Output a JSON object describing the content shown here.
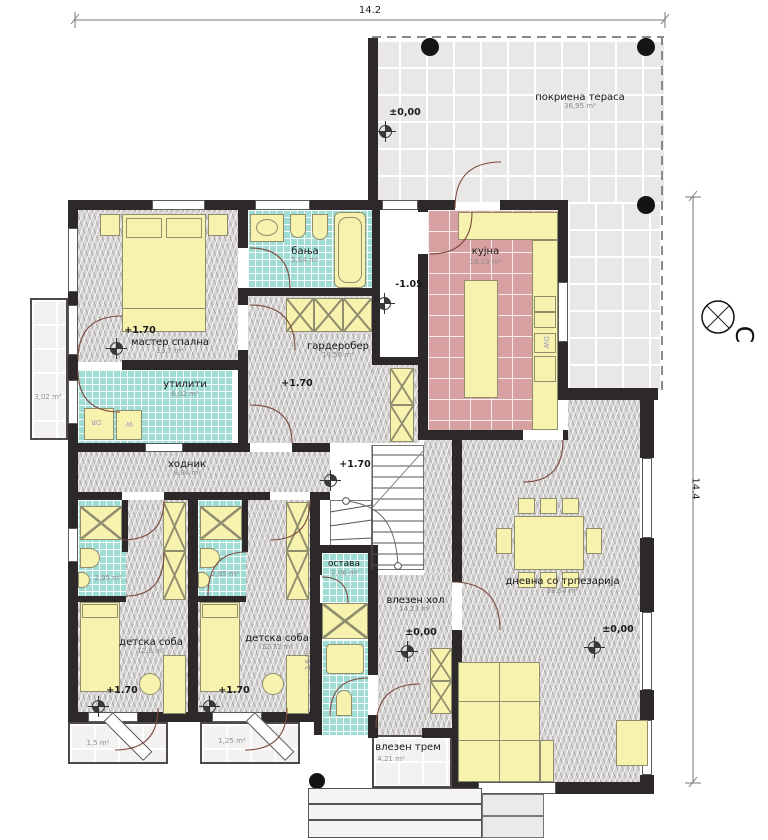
{
  "plan": {
    "dim_width": "14.2",
    "dim_height": "14.4",
    "north": "С"
  },
  "rooms": {
    "terrace": {
      "name": "покриена тераса",
      "area": "36,95 m²",
      "level": "±0,00"
    },
    "master": {
      "name": "мастер спална",
      "area": "13,7 m²",
      "level": "+1.70"
    },
    "master_balcony": {
      "area": "3,02 m²"
    },
    "bath": {
      "name": "бања",
      "area": "5,64 m²"
    },
    "wardrobe": {
      "name": "гардеробер",
      "area": "14,56 m²",
      "level": "+1.70"
    },
    "landing": {
      "level": "-1.05"
    },
    "kitchen": {
      "name": "кујна",
      "area": "18,19 m²"
    },
    "utility": {
      "name": "утилити",
      "area": "6,02 m²"
    },
    "hallway": {
      "name": "ходник",
      "area": "8,84 m²",
      "level": "+1.70"
    },
    "kids1": {
      "name": "детска соба",
      "area": "12,8 m²",
      "level": "+1.70"
    },
    "kids1_bath": {
      "area": "2,95 m²"
    },
    "kids2": {
      "name": "детска соба",
      "area": "12,71 m²",
      "level": "+1.70"
    },
    "kids2_bath": {
      "area": "2,85 m²"
    },
    "storage": {
      "name": "остава",
      "area": "2,06 m²"
    },
    "wc": {
      "area": "2,6 m²"
    },
    "entry_hall": {
      "name": "влезен хол",
      "area": "14,23 m²",
      "level": "±0,00"
    },
    "living": {
      "name": "дневна со трпезарија",
      "area": "38,54 m²",
      "level": "±0,00"
    },
    "porch": {
      "name": "влезен трем",
      "area": "4,21 m²"
    },
    "kids1_balcony": {
      "area": "1,5 m²"
    },
    "kids2_balcony": {
      "area": "1,25 m²"
    }
  },
  "appliances": {
    "dishwasher": "DW",
    "washer": "W",
    "dryer": "DR"
  },
  "colors": {
    "wall": "#2d292a",
    "tile_teal": "#9edcd4",
    "tile_pink": "#d6a1a0",
    "tile_gray": "#e9e8e6",
    "furniture": "#f7f2ae",
    "door": "#7d4a3e"
  }
}
